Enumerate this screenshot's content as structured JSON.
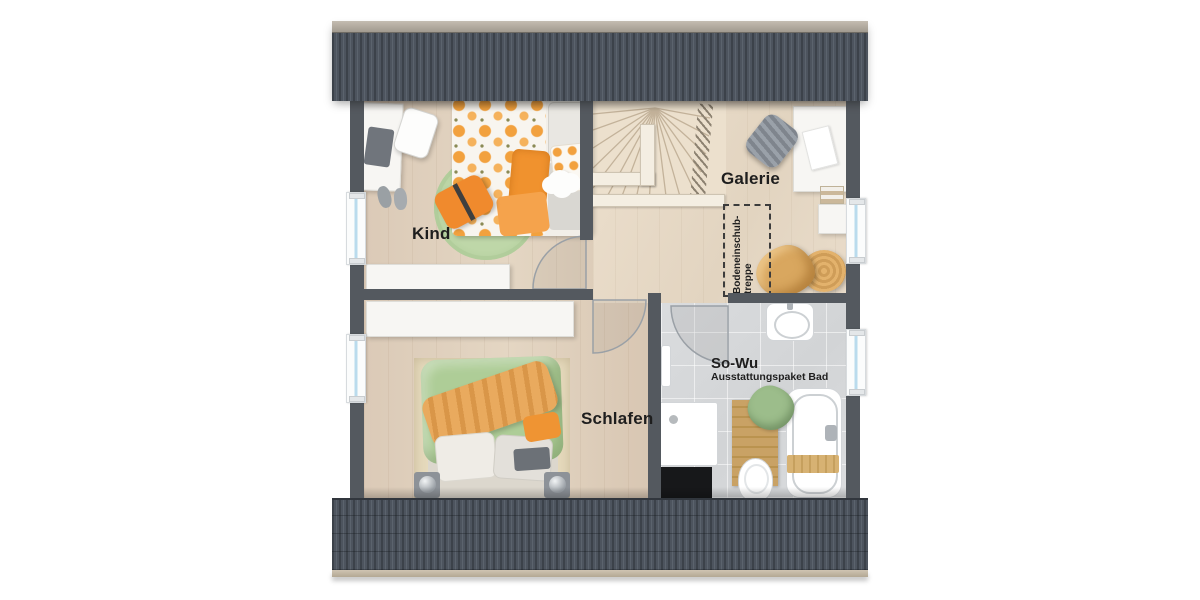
{
  "plan": {
    "floor_name_hint": "attic floor plan",
    "labels": {
      "kind": "Kind",
      "galerie": "Galerie",
      "schlafen": "Schlafen",
      "bad_title": "So-Wu",
      "bad_subtitle": "Ausstattungspaket Bad",
      "attic_hatch_line1": "Bodeneinschub-",
      "attic_hatch_line2": "treppe"
    },
    "rooms": [
      {
        "id": "kind",
        "label": "Kind"
      },
      {
        "id": "galerie",
        "label": "Galerie"
      },
      {
        "id": "schlafen",
        "label": "Schlafen"
      },
      {
        "id": "bad",
        "label": "So-Wu",
        "sublabel": "Ausstattungspaket Bad"
      }
    ],
    "furniture_icons": {
      "kind": [
        "desk-icon",
        "laptop-icon",
        "desk-chair-icon",
        "slippers-icon",
        "single-bed-icon",
        "polka-dot-duvet-icon",
        "pillow-icon",
        "round-rug-icon",
        "cushion-icon",
        "cloud-rug-icon",
        "sideboard-icon"
      ],
      "galerie": [
        "desk-icon",
        "office-chair-icon",
        "paper-icon",
        "books-icon",
        "shelf-icon",
        "beanbag-icon",
        "pouf-icon",
        "attic-hatch-icon",
        "stair-icon",
        "railing-icon"
      ],
      "schlafen": [
        "sideboard-icon",
        "double-bed-icon",
        "duvet-icon",
        "throw-blanket-icon",
        "pillow-icon",
        "rug-icon",
        "nightstand-icon",
        "ball-lamp-icon"
      ],
      "bad": [
        "shower-tray-icon",
        "shower-faucet-icon",
        "towel-radiator-icon",
        "washbasin-icon",
        "toilet-icon",
        "bathtub-icon",
        "bath-caddy-icon",
        "wooden-mat-icon",
        "towel-icon",
        "floor-opening-icon",
        "door-arc-icon"
      ]
    },
    "colors": {
      "roof": "#49505a",
      "roof_ridge": "#b3aba0",
      "wall": "#54595f",
      "wood_floor": "#decdb9",
      "gallery_floor": "#e7dbc9",
      "tile_floor": "#d7d9db",
      "accent_orange": "#f0922e",
      "accent_green": "#aecd97",
      "window_glass": "#badbed",
      "label_text": "#1e1e1e"
    }
  }
}
